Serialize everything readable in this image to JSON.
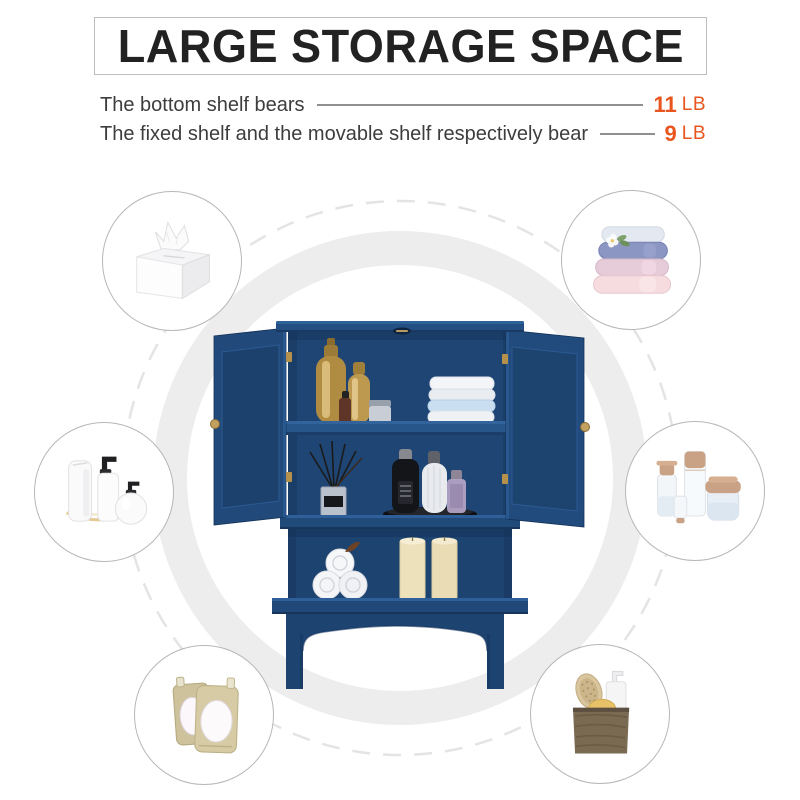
{
  "header": {
    "title": "LARGE STORAGE SPACE",
    "specs": [
      {
        "label": "The bottom shelf bears",
        "value": "11",
        "unit": "LB"
      },
      {
        "label": "The fixed shelf and the movable shelf respectively bear",
        "value": "9",
        "unit": "LB"
      }
    ]
  },
  "colors": {
    "accent_orange": "#E8551F",
    "cabinet_blue": "#1F4A79",
    "ring_gray": "#EDEDED",
    "dashed_ring_gray": "#E4E4E4",
    "circle_border_gray": "#B7B7B7",
    "connector_line_gray": "#8F8F8F"
  },
  "product": {
    "name": "navy blue two-door wall storage cabinet with doors open",
    "top_shelf_contents": "gold cosmetic bottles, small jar, folded towels",
    "middle_shelf_contents": "reed diffuser, black bottle, white bottle, perfume bottle on black tray",
    "open_shelf_contents": "rolled white towels, two cream pillar candles"
  },
  "storage_examples": [
    {
      "id": "tissue-box",
      "label": "tissue box"
    },
    {
      "id": "folded-towels",
      "label": "stack of folded towels"
    },
    {
      "id": "lotion-set",
      "label": "white lotion bottles"
    },
    {
      "id": "skincare-set",
      "label": "skincare bottles and cream jar"
    },
    {
      "id": "refill-pouches",
      "label": "refill pouches"
    },
    {
      "id": "bath-set",
      "label": "bath brush, sponge and soap in kraft bag"
    }
  ]
}
